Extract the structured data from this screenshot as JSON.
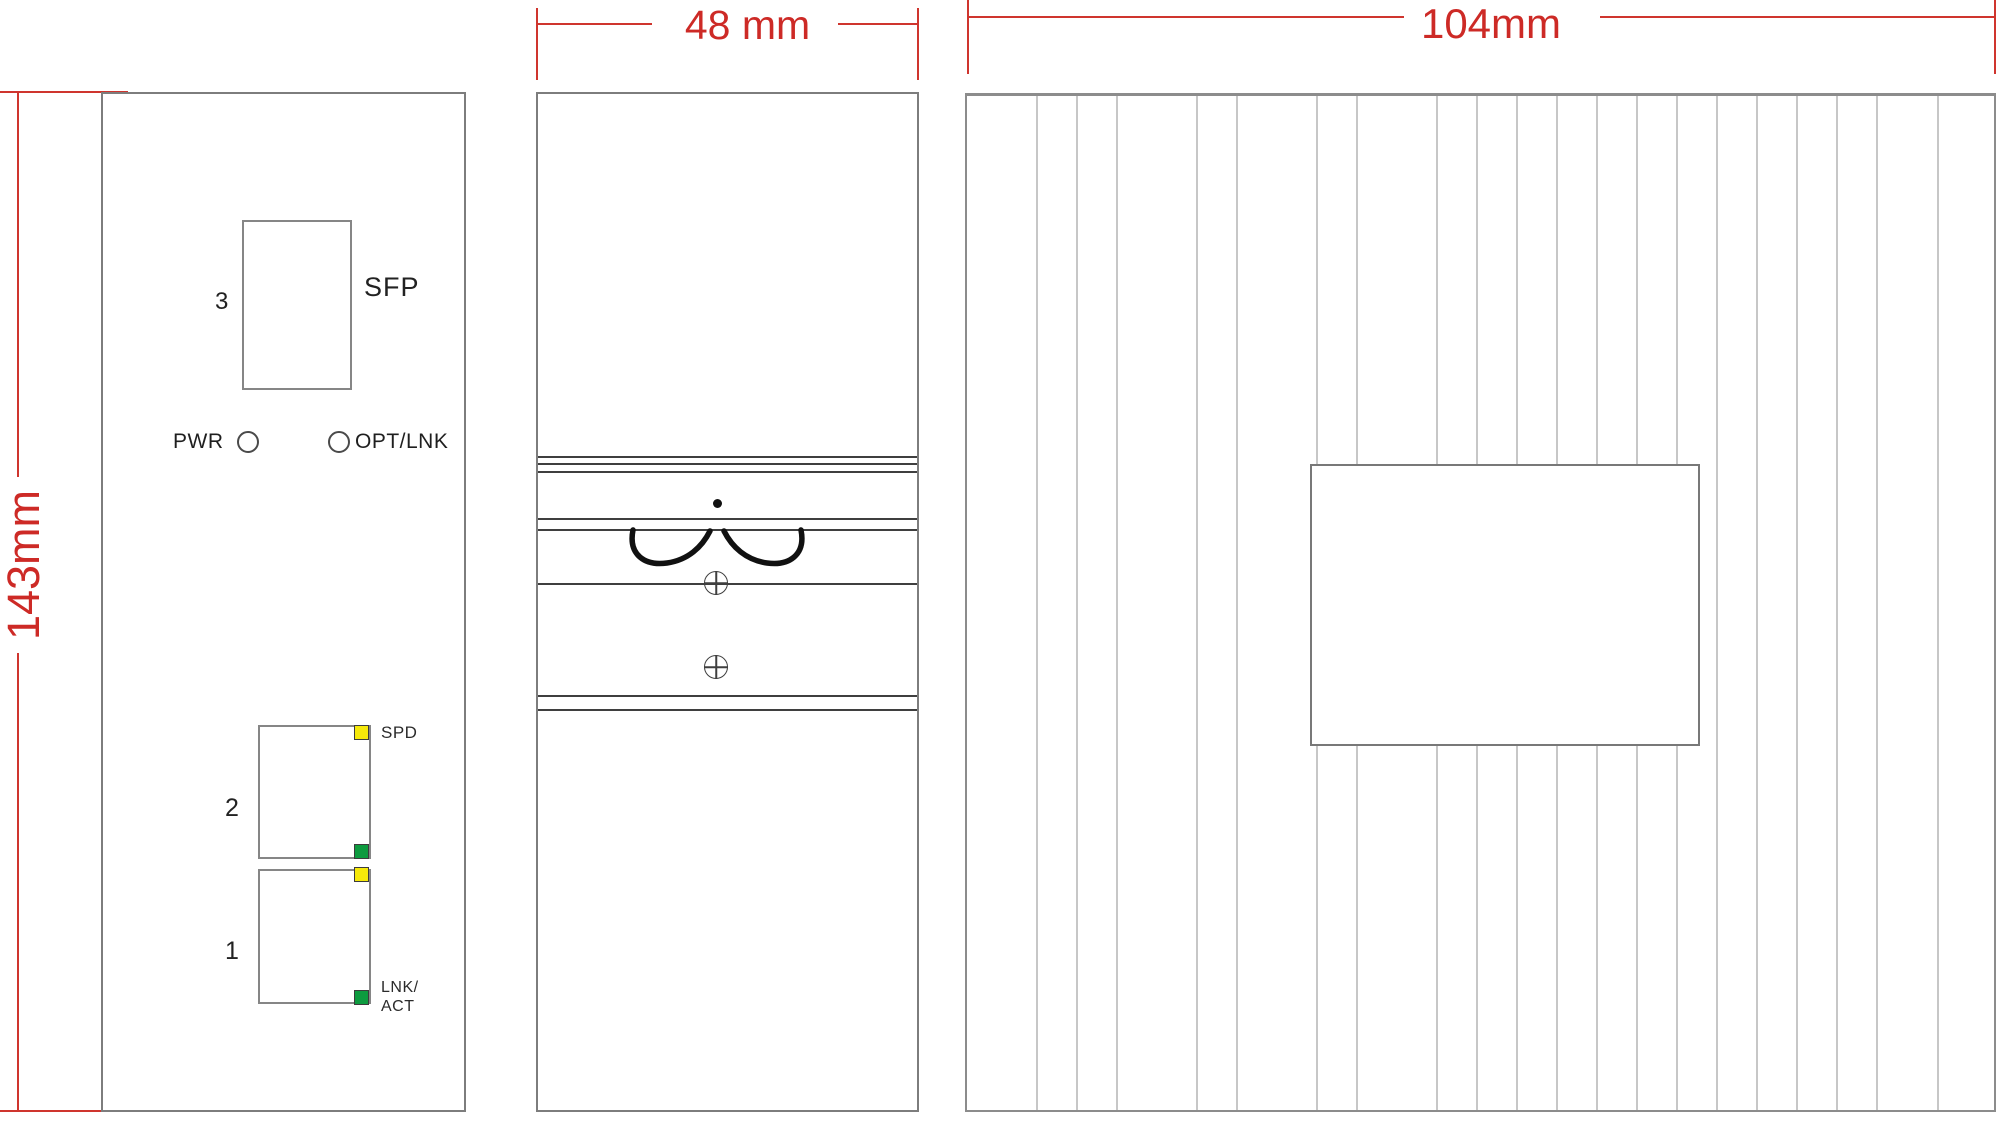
{
  "dimensions": {
    "height": {
      "label": "143mm"
    },
    "depth": {
      "label": "48 mm"
    },
    "width": {
      "label": "104mm"
    },
    "line_color": "#cd2a26"
  },
  "front_view": {
    "sfp_port": {
      "number": "3",
      "label": "SFP"
    },
    "status_row": {
      "pwr_label": "PWR",
      "opt_lnk_label": "OPT/LNK"
    },
    "port2": {
      "number": "2",
      "spd_label": "SPD"
    },
    "port1": {
      "number": "1",
      "lnk_act_line1": "LNK/",
      "lnk_act_line2": "ACT"
    },
    "led_colors": {
      "speed_yellow": "#f6e90a",
      "link_green": "#0d9b3f"
    }
  },
  "top_view": {
    "fin_offsets_px": [
      69,
      109,
      149,
      229,
      269,
      349,
      389,
      469,
      509,
      549,
      589,
      629,
      669,
      709,
      749,
      789,
      829,
      869,
      909,
      970
    ]
  }
}
